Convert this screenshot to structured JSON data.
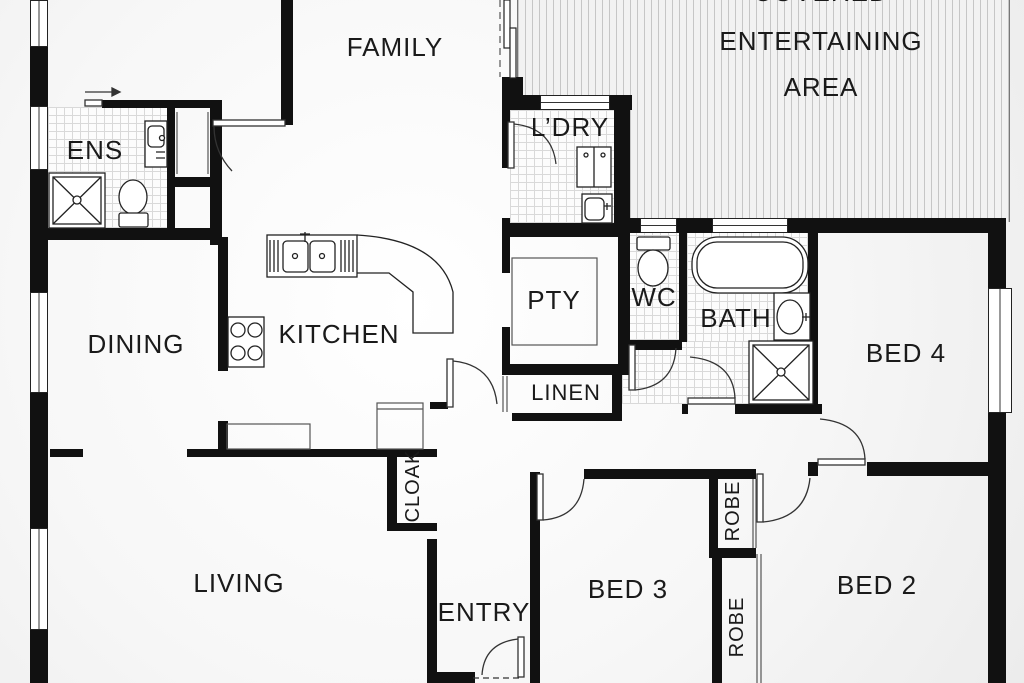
{
  "plan": {
    "title": "Residential floor plan",
    "rooms": {
      "bed1": "BED 1",
      "family": "FAMILY",
      "covered_line1": "COVERED",
      "covered_line2": "ENTERTAINING",
      "covered_line3": "AREA",
      "ens": "ENS",
      "ldry": "L’DRY",
      "dining": "DINING",
      "kitchen": "KITCHEN",
      "pty": "PTY",
      "wc": "WC",
      "bath": "BATH",
      "bed4": "BED 4",
      "linen": "LINEN",
      "cloak": "CLOAK",
      "living": "LIVING",
      "entry": "ENTRY",
      "bed3": "BED 3",
      "bed2": "BED 2",
      "robe_bed3": "ROBE",
      "robe_bed2": "ROBE"
    },
    "colors": {
      "wall": "#111111",
      "fixture_line": "#222222",
      "tile_grid": "#d9d9d9",
      "deck_stripe": "#c6c6c6",
      "text": "#1a1a1a"
    }
  }
}
